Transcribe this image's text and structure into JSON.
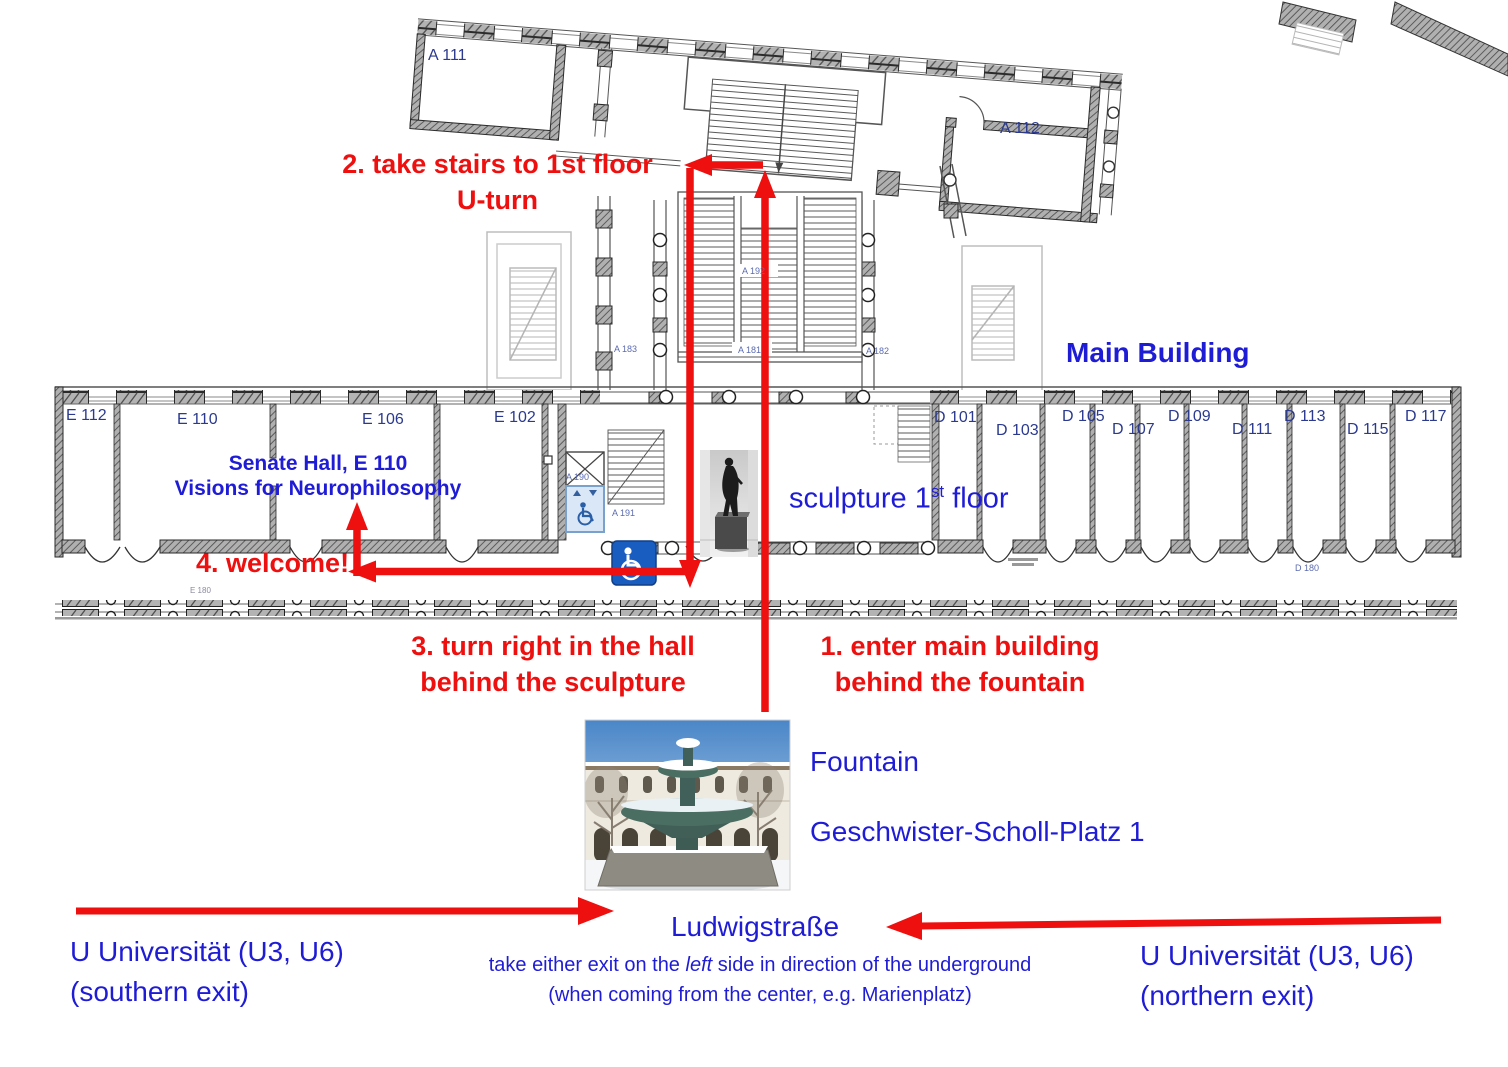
{
  "colors": {
    "route_red": "#ee0f0f",
    "label_blue": "#1f1cd6",
    "room_label_navy": "#2b3a8f",
    "small_label_blue": "#5b6bb0"
  },
  "instructions": {
    "step1": {
      "line1": "1. enter main building",
      "line2": "behind the fountain"
    },
    "step2": {
      "line1": "2. take stairs to 1st floor",
      "line2": "U-turn"
    },
    "step3": {
      "line1": "3. turn right in the hall",
      "line2": "behind the sculpture"
    },
    "step4": "4. welcome!"
  },
  "map_labels": {
    "main_building": "Main Building",
    "senate_hall": {
      "line1": "Senate Hall, E 110",
      "line2": "Visions for Neurophilosophy"
    },
    "sculpture": {
      "pre": "sculpture 1",
      "sup": "st",
      "post": " floor"
    }
  },
  "bottom": {
    "fountain": "Fountain",
    "address": "Geschwister-Scholl-Platz 1",
    "street": "Ludwigstraße",
    "south_exit": {
      "line1": "U Universität (U3, U6)",
      "line2": "(southern exit)"
    },
    "north_exit": {
      "line1": "U Universität (U3, U6)",
      "line2": "(northern exit)"
    },
    "note": {
      "pre": "take either exit on the ",
      "italic": "left",
      "post": " side in direction of the underground",
      "line2": "(when coming from the center, e.g. Marienplatz)"
    }
  },
  "rooms": {
    "a111": "A 111",
    "a112": "A 112",
    "e112": "E 112",
    "e110": "E 110",
    "e106": "E 106",
    "e102": "E 102",
    "d101": "D 101",
    "d103": "D 103",
    "d105": "D 105",
    "d107": "D 107",
    "d109": "D 109",
    "d111": "D 111",
    "d113": "D 113",
    "d115": "D 115",
    "d117": "D 117",
    "a183": "A 183",
    "a181": "A 181",
    "a182": "A 182",
    "a192": "A 192",
    "a191": "A 191",
    "a190": "A 190",
    "d180": "D 180",
    "e180": "E 180"
  }
}
